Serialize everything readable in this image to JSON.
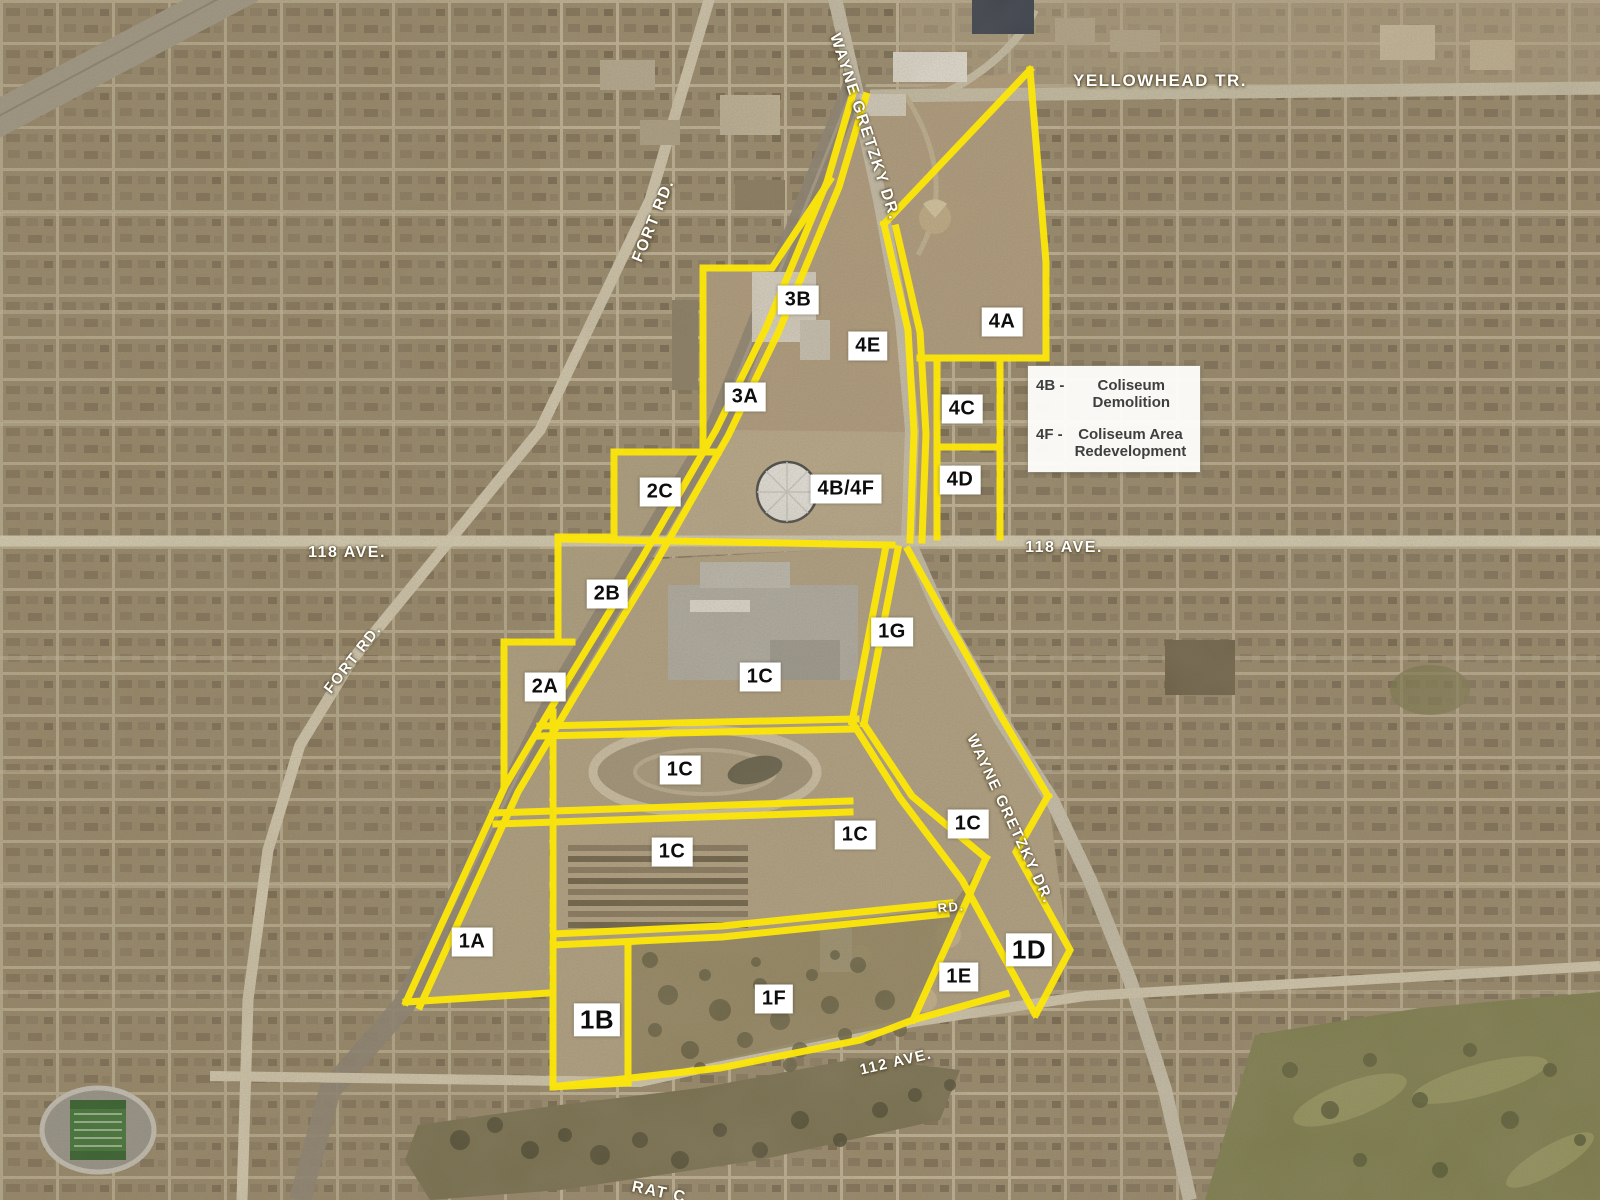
{
  "colors": {
    "boundary_yellow": "#fce60a",
    "chip_bg": "#ffffff",
    "chip_text": "#0d0d0d",
    "street_label": "#ffffff",
    "legend_bg": "#fdfdfb",
    "legend_text": "#3f3f3f"
  },
  "legend": {
    "separator": " - ",
    "items": [
      {
        "code": "4B",
        "label": "Coliseum Demolition"
      },
      {
        "code": "4F",
        "label": "Coliseum Area Redevelopment"
      }
    ]
  },
  "zones": [
    {
      "label": "3B",
      "x": 798,
      "y": 300
    },
    {
      "label": "4E",
      "x": 868,
      "y": 346
    },
    {
      "label": "4A",
      "x": 1002,
      "y": 322
    },
    {
      "label": "3A",
      "x": 745,
      "y": 397
    },
    {
      "label": "4C",
      "x": 962,
      "y": 409
    },
    {
      "label": "4B/4F",
      "x": 846,
      "y": 489
    },
    {
      "label": "4D",
      "x": 960,
      "y": 480
    },
    {
      "label": "2C",
      "x": 660,
      "y": 492
    },
    {
      "label": "2B",
      "x": 607,
      "y": 594
    },
    {
      "label": "1G",
      "x": 892,
      "y": 632
    },
    {
      "label": "2A",
      "x": 545,
      "y": 687
    },
    {
      "label": "1C",
      "x": 760,
      "y": 677
    },
    {
      "label": "1C",
      "x": 680,
      "y": 770
    },
    {
      "label": "1C",
      "x": 855,
      "y": 835
    },
    {
      "label": "1C",
      "x": 968,
      "y": 824
    },
    {
      "label": "1C",
      "x": 672,
      "y": 852
    },
    {
      "label": "1A",
      "x": 472,
      "y": 942
    },
    {
      "label": "1D",
      "x": 1029,
      "y": 950,
      "big": true
    },
    {
      "label": "1E",
      "x": 959,
      "y": 977
    },
    {
      "label": "1B",
      "x": 597,
      "y": 1020,
      "big": true
    },
    {
      "label": "1F",
      "x": 774,
      "y": 999
    }
  ],
  "streets": [
    {
      "label": "YELLOWHEAD TR.",
      "x": 1160,
      "y": 81,
      "rot": 0,
      "fs": 17
    },
    {
      "label": "WAYNE GRETZKY DR.",
      "x": 864,
      "y": 127,
      "rot": 72,
      "fs": 16
    },
    {
      "label": "FORT RD.",
      "x": 654,
      "y": 221,
      "rot": -68,
      "fs": 16
    },
    {
      "label": "118 AVE.",
      "x": 347,
      "y": 553,
      "rot": 0,
      "fs": 16
    },
    {
      "label": "118 AVE.",
      "x": 1064,
      "y": 548,
      "rot": 0,
      "fs": 16
    },
    {
      "label": "FORT RD.",
      "x": 353,
      "y": 659,
      "rot": -52,
      "fs": 15
    },
    {
      "label": "WAYNE GRETZKY DR.",
      "x": 1010,
      "y": 819,
      "rot": 65,
      "fs": 15
    },
    {
      "label": "RD.",
      "x": 951,
      "y": 907,
      "rot": -5,
      "fs": 13
    },
    {
      "label": "112 AVE.",
      "x": 896,
      "y": 1062,
      "rot": -13,
      "fs": 15
    },
    {
      "label": "RAT C",
      "x": 659,
      "y": 1193,
      "rot": 12,
      "fs": 16
    }
  ]
}
